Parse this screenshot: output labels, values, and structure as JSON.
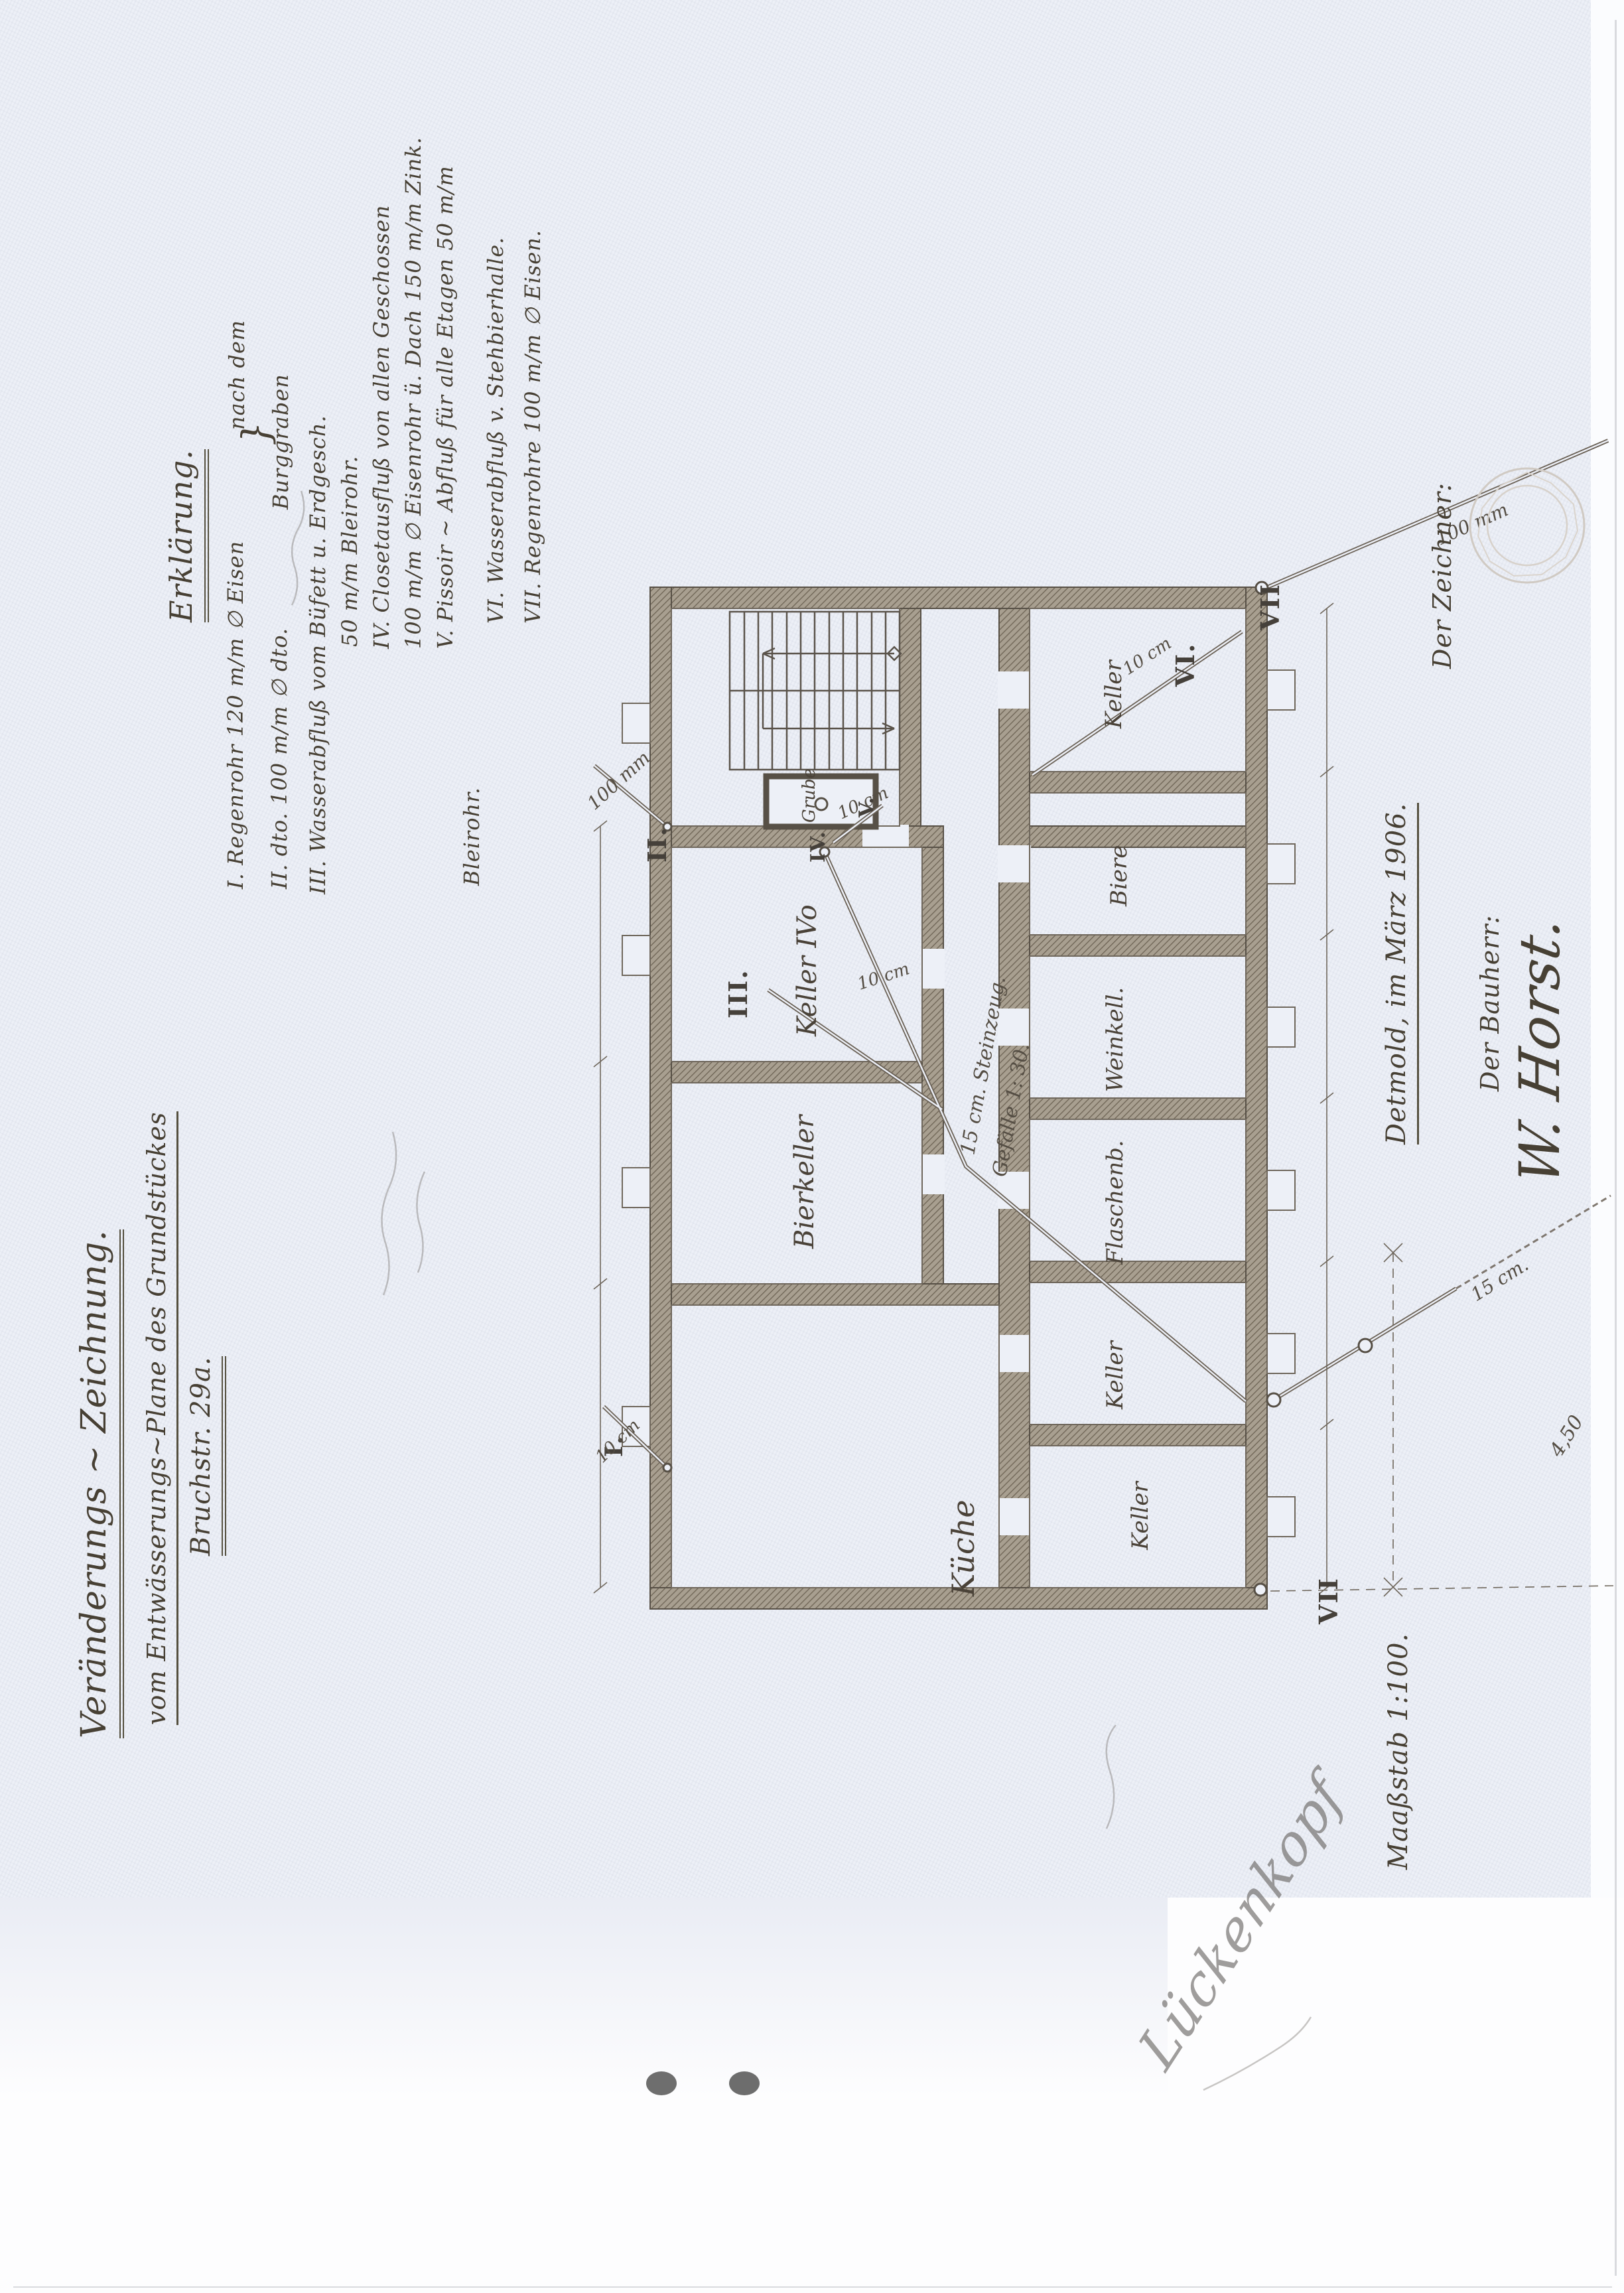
{
  "colors": {
    "paper": "#edf0f7",
    "ink": "#474034",
    "wall": "#a89f90",
    "pencil": "#8e8a84"
  },
  "title": {
    "line1": "Veränderungs ~ Zeichnung.",
    "line2": "vom Entwässerungs~Plane des Grundstückes",
    "line3": "Bruchstr. 29a."
  },
  "legend": {
    "heading": "Erklärung.",
    "brace": "}",
    "brace_note1": "nach dem",
    "brace_note2": "Burggraben",
    "items": [
      "I. Regenrohr 120 m/m ∅ Eisen",
      "II. dto. 100 m/m ∅ dto.",
      "III. Wasserabfluß vom Büfett u. Erdgesch.",
      "50 m/m Bleirohr.",
      "IV. Closetausfluß von allen Geschossen",
      "100 m/m ∅ Eisenrohr ü. Dach 150 m/m Zink.",
      "V. Pissoir ~ Abfluß für alle Etagen 50 m/m",
      "Bleirohr.",
      "VI. Wasserabfluß v. Stehbierhalle.",
      "VII. Regenrohre 100 m/m ∅ Eisen."
    ]
  },
  "plan": {
    "rooms": {
      "grube": "Grube",
      "keller_ivo": "Keller IVo",
      "bierkeller": "Bierkeller",
      "kueche": "Küche",
      "band1": "Keller",
      "band2": "Biere",
      "band3": "Weinkell.",
      "band4": "Flaschenb.",
      "band5": "Keller",
      "band6": "Keller"
    },
    "markers": {
      "i": "I.",
      "ii": "II.",
      "iii": "III.",
      "iv": "IV.",
      "v": "V.",
      "vi": "VI.",
      "vii_top": "VII",
      "vii_bottom": "VII"
    },
    "pipe_labels": {
      "d100_left": "100 mm",
      "d100_right": "100 mm",
      "d10_grube": "10 cm",
      "d10_keller": "10 cm",
      "d10_vi": "10 cm",
      "d10_i": "10 cm",
      "d15_exit": "15 cm.",
      "dim_450": "4,50",
      "steinzeug": "15 cm. Steinzeug.",
      "gefaelle": "Gefälle 1: 30."
    }
  },
  "footer": {
    "date": "Detmold, im März 1906.",
    "zeichner_label": "Der Zeichner:",
    "bauherr_label": "Der Bauherr:",
    "bauherr_signature": "W. Horst.",
    "scale": "Maaßstab 1:100.",
    "pencil_signature": "Lückenkopf"
  }
}
